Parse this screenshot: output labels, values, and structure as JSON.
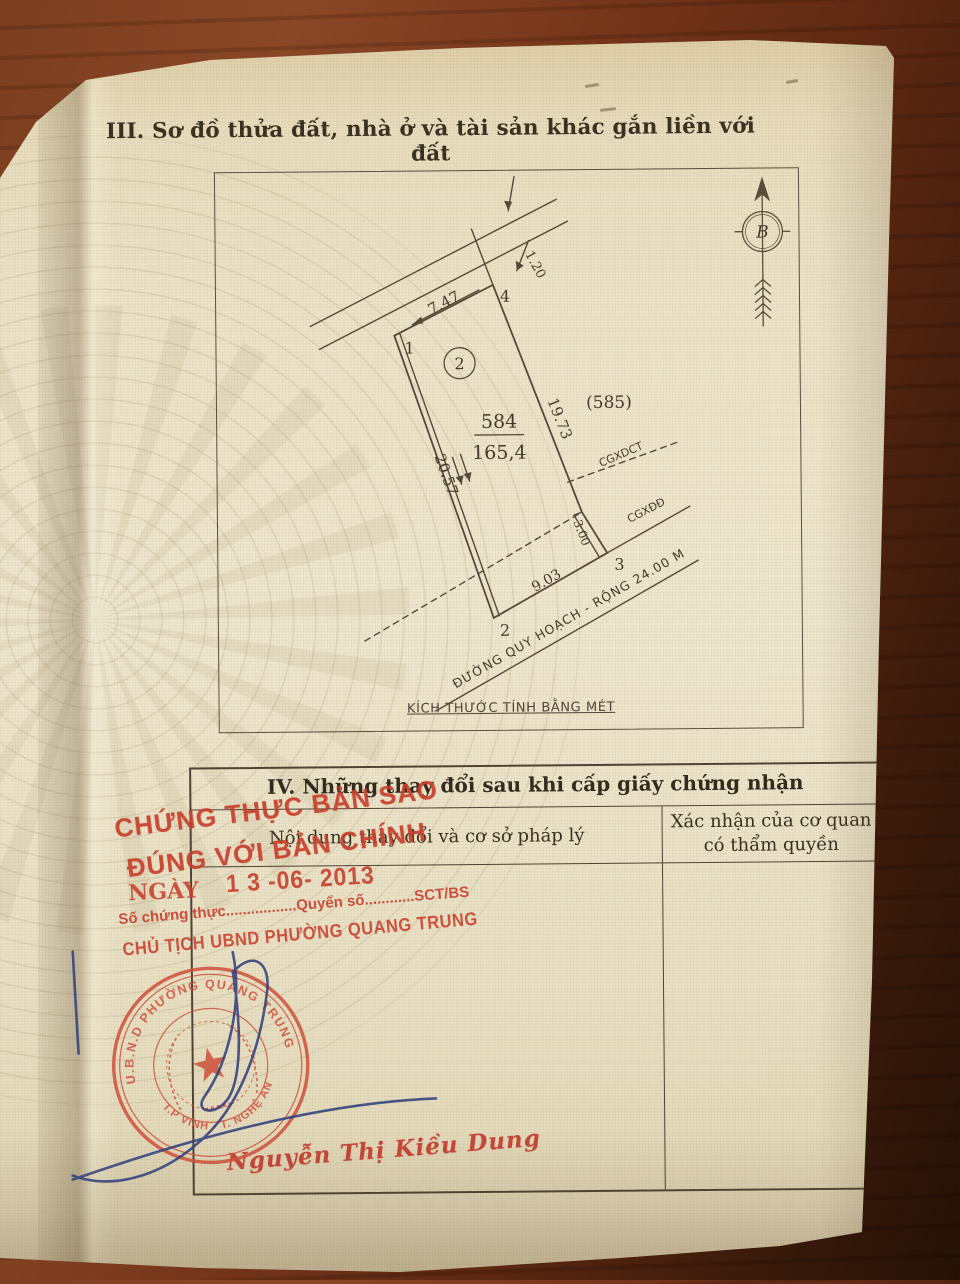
{
  "page": {
    "section3_title": "III. Sơ đồ thửa đất, nhà ở và tài sản khác gắn liền với đất",
    "section4_title": "IV. Những thay đổi sau khi cấp giấy chứng nhận"
  },
  "diagram": {
    "north_label": "B",
    "scale_note": "KÍCH THƯỚC TÍNH BẰNG MÉT",
    "plot_number": "584",
    "plot_area": "165,4",
    "adjacent_plot": "(585)",
    "unit_circle_label": "2",
    "vertices": {
      "v1": "1",
      "v2": "2",
      "v3": "3",
      "v4": "4"
    },
    "measures": {
      "top_edge": "7.47",
      "left_edge": "20.57",
      "right_edge": "19.73",
      "bottom_edge": "9.03",
      "setback_strip": "3.00",
      "road_offset": "1.20"
    },
    "boundary_cgxdct": "CGXDCT",
    "boundary_cgxdd": "CGXĐĐ",
    "road_label": "ĐƯỜNG QUY HOẠCH - RỘNG 24.00 M"
  },
  "table": {
    "col1_header": "Nội dung thay đổi và cơ sở pháp lý",
    "col2_header_line1": "Xác nhận của cơ quan",
    "col2_header_line2": "có thẩm quyền"
  },
  "stamps": {
    "certify_line1": "CHỨNG THỰC BẢN SAO",
    "certify_line2": "ĐÚNG VỚI BẢN CHÍNH",
    "date_label": "NGÀY",
    "date_value": "1 3 -06- 2013",
    "serial_line": "Số chứng thực.................Quyển số............SCT/BS",
    "chairman_line": "CHỦ TỊCH UBND PHƯỜNG QUANG TRUNG",
    "signer_name": "Nguyễn Thị Kiều Dung",
    "seal_top": "U.B.N.D PHƯỜNG QUANG TRUNG",
    "seal_bottom": "T.P VINH - T. NGHỆ AN"
  },
  "colors": {
    "stamp_red": "#c8402c",
    "seal_red": "#cf503a",
    "pen_blue": "#33427d",
    "paper": "#ece3c8",
    "wood": "#713618",
    "ink": "#57493a"
  }
}
